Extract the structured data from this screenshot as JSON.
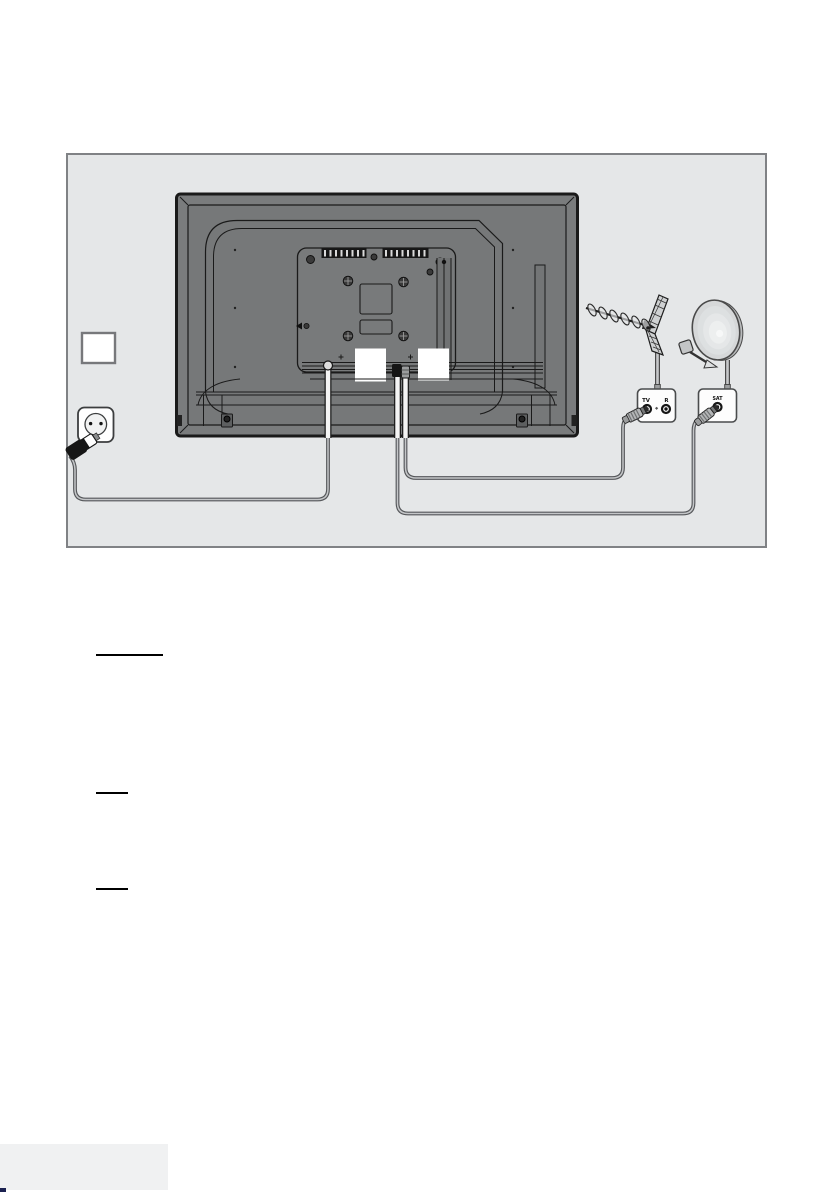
{
  "page": {
    "type": "tv-manual-connection-diagram-page",
    "background_color": "#ffffff"
  },
  "diagram": {
    "background_color": "#e5e7e8",
    "border_color": "#808285",
    "labels": {
      "antenna_outlet_tv": "TV",
      "antenna_outlet_r": "R",
      "satellite_outlet": "SAT"
    },
    "colors": {
      "tv_body": "#7a7c7d",
      "line": "#1a1a1a",
      "cable_outer": "#55575a",
      "cable_inner": "#c4c6c8",
      "dish_fill": "#d6d8d9",
      "outlet_box_fill": "#fdfdfd"
    },
    "icons": [
      "tv-rear-icon",
      "power-plug-icon",
      "wall-socket-icon",
      "blank-label-square-icon",
      "terrestrial-antenna-icon",
      "satellite-dish-icon",
      "antenna-wall-outlet-icon",
      "satellite-wall-outlet-icon",
      "coax-plug-icon"
    ]
  },
  "body_text": {
    "note": "text content not rendered in source scan; only heading underlines visible"
  },
  "footer": {
    "tab_color": "#f0f1f2",
    "accent_color": "#1b2150"
  }
}
